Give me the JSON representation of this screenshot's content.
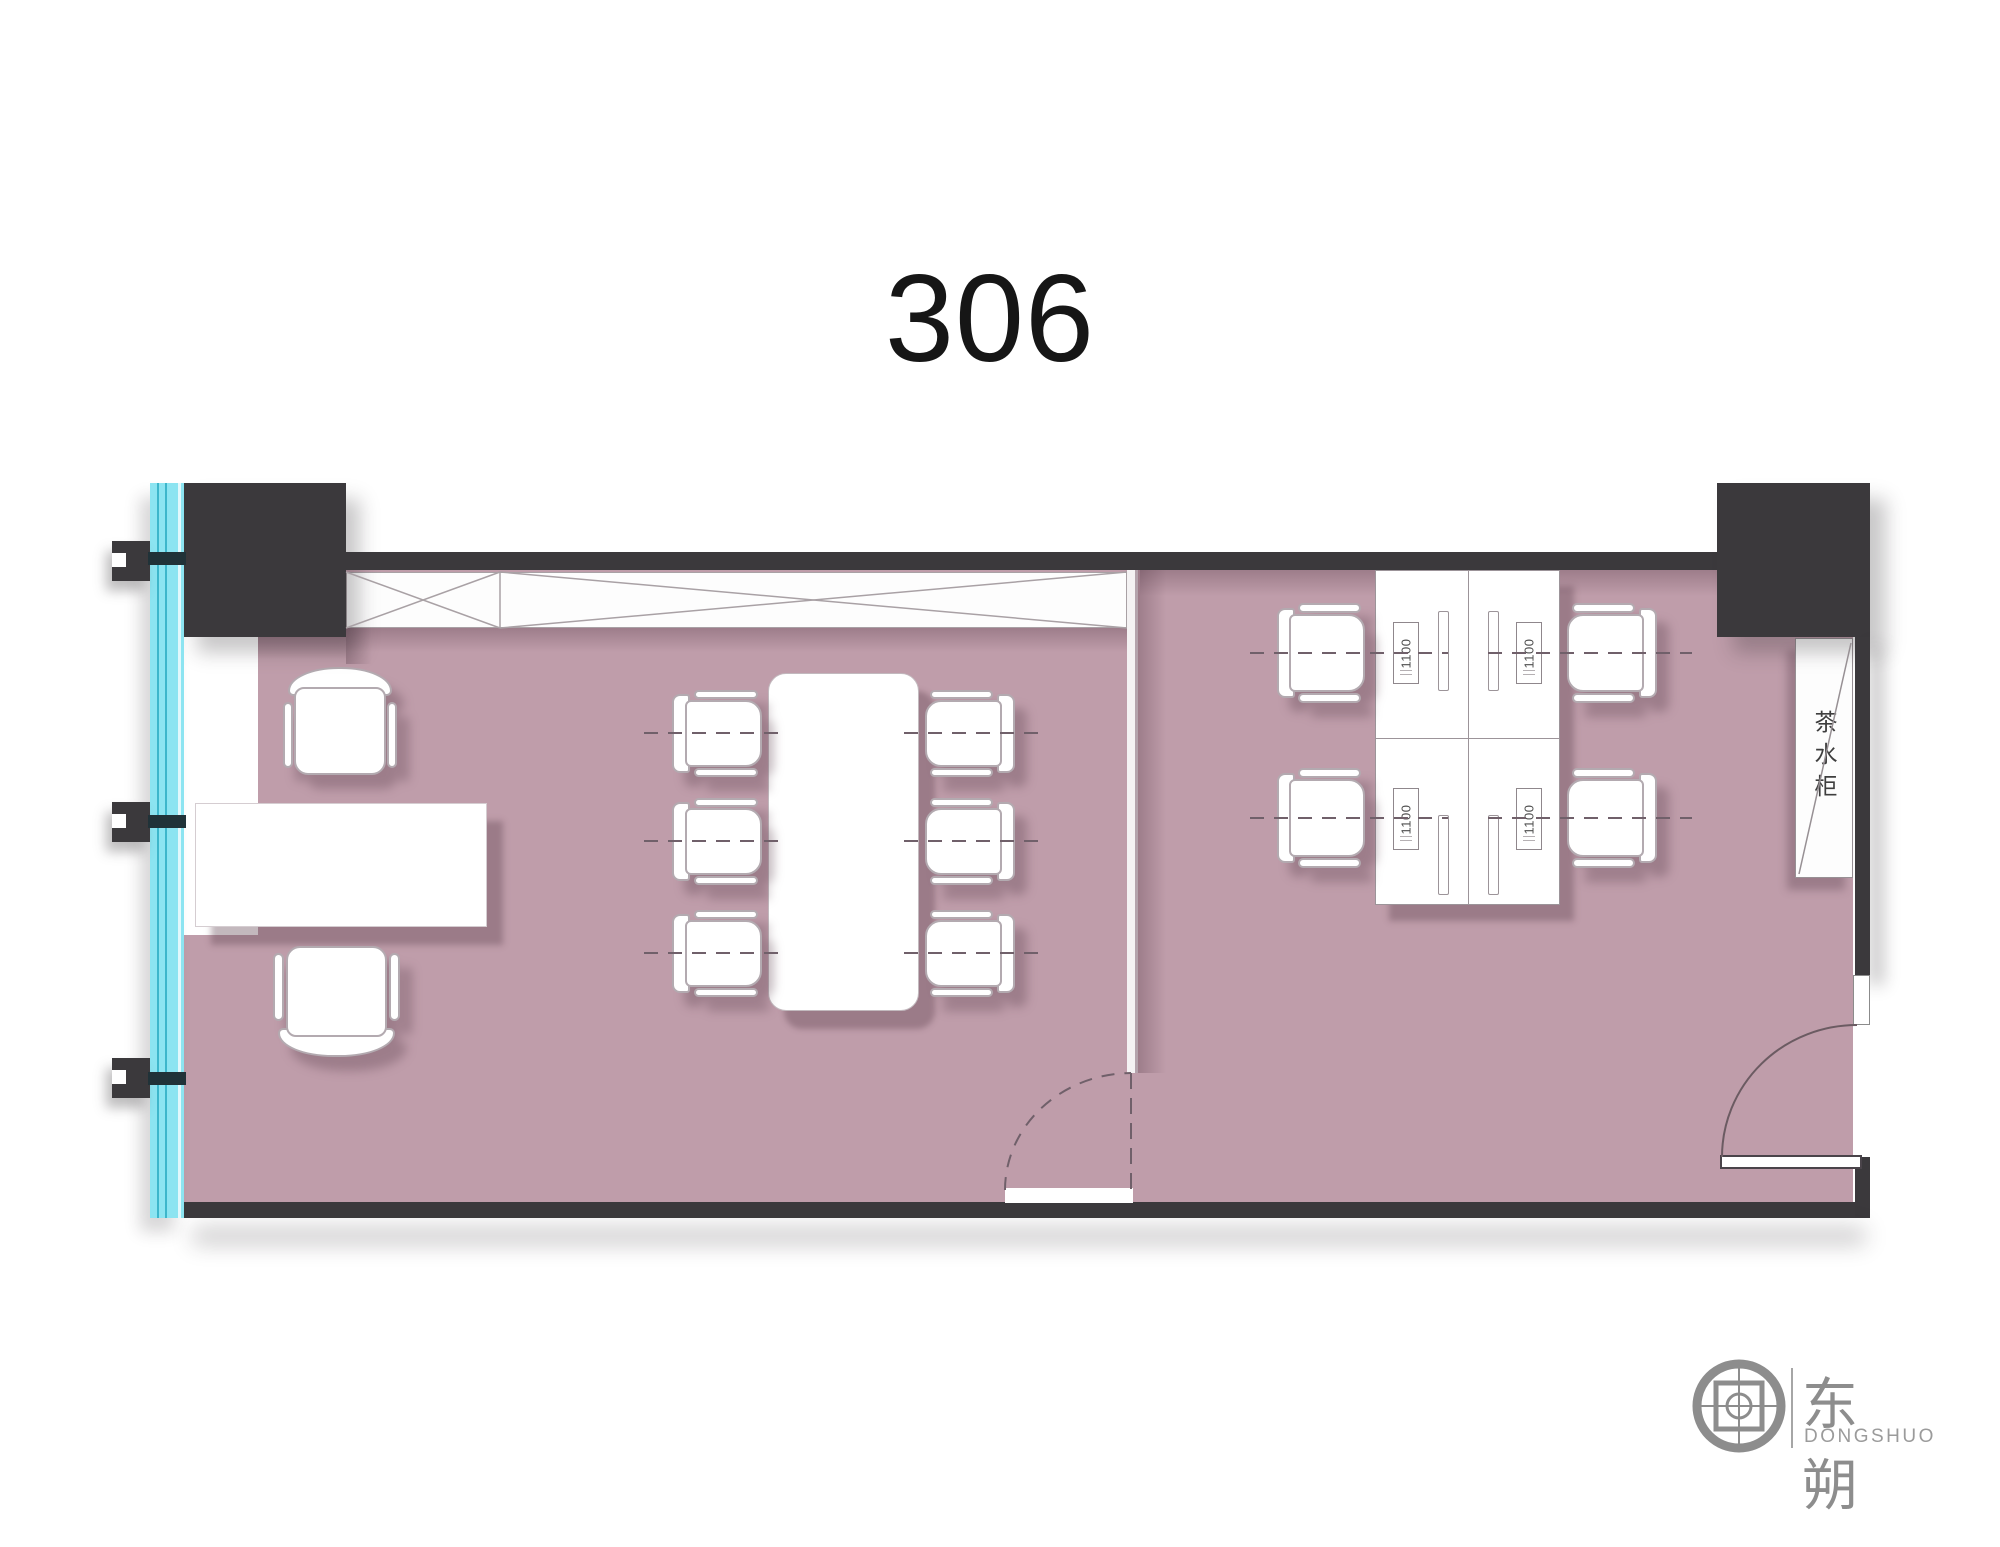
{
  "title": "306",
  "plan": {
    "tea_cabinet_label": "茶水柜",
    "desk_labels": [
      "1100",
      "1100",
      "1100",
      "1100"
    ],
    "colors": {
      "floor": "#bf9daa",
      "wall": "#3b393c",
      "window_glass": "#8ce4f1",
      "furniture_outline": "#b3aab0",
      "logo_gray": "#8d8d8d",
      "title_text": "#161616"
    },
    "contents": {
      "left_room": [
        "executive desk",
        "executive chair",
        "guest chair",
        "conference table with 6 chairs",
        "wardrobe strip"
      ],
      "right_room": [
        "4 workstation desks",
        "4 task chairs",
        "tea cabinet"
      ]
    }
  },
  "logo": {
    "zh": "东朔",
    "en": "DONGSHUO"
  }
}
